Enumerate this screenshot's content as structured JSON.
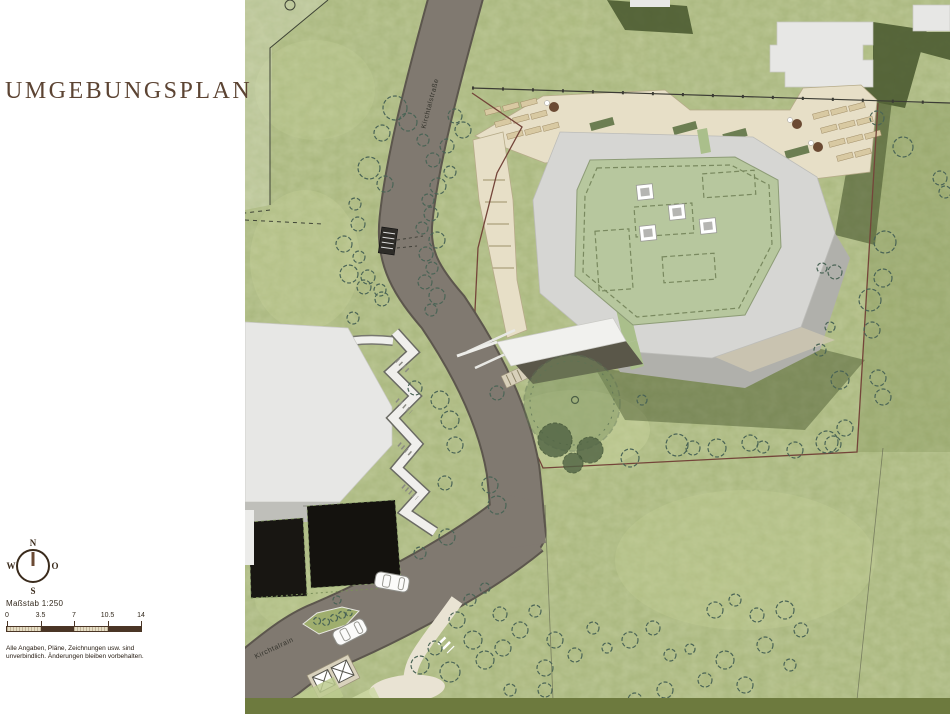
{
  "panel": {
    "title": "UMGEBUNGSPLAN",
    "scale_label": "Maßstab 1:250",
    "scale_ticks": [
      "0",
      "3.5",
      "7",
      "10.5",
      "14"
    ],
    "disclaimer_line1": "Alle Angaben, Pläne, Zeichnungen usw. sind",
    "disclaimer_line2": "unverbindlich. Änderungen bleiben vorbehalten.",
    "compass": {
      "north": "N",
      "east": "O",
      "south": "S",
      "west": "W"
    }
  },
  "map": {
    "street_labels": [
      {
        "text": "Kirchtalstraße",
        "x": 187,
        "y": 104,
        "rotate": -75
      },
      {
        "text": "Kirchtalrain",
        "x": 30,
        "y": 650,
        "rotate": -25
      }
    ],
    "palette": {
      "grass": "#a9b77c",
      "grassdark": "#46552c",
      "road": "#807970",
      "roadedge": "#5c564d",
      "beige": "#e7dfc7",
      "deck": "#d8c9a2",
      "rooflight": "#d6d6d3",
      "roofgreen": "#b7c79e",
      "boundary": "#74453a",
      "tree": "#4a6456",
      "title": "#5c4433",
      "band": "#6d7a3e"
    },
    "trees": [
      [
        150,
        108,
        12
      ],
      [
        163,
        122,
        9
      ],
      [
        137,
        133,
        8
      ],
      [
        178,
        140,
        6
      ],
      [
        124,
        168,
        11
      ],
      [
        140,
        184,
        8
      ],
      [
        110,
        204,
        6
      ],
      [
        113,
        224,
        7
      ],
      [
        99,
        244,
        8
      ],
      [
        114,
        257,
        6
      ],
      [
        104,
        274,
        9
      ],
      [
        119,
        287,
        7
      ],
      [
        137,
        299,
        7
      ],
      [
        108,
        318,
        6
      ],
      [
        123,
        277,
        7
      ],
      [
        135,
        290,
        6
      ],
      [
        210,
        116,
        7
      ],
      [
        218,
        130,
        8
      ],
      [
        202,
        146,
        7
      ],
      [
        188,
        160,
        7
      ],
      [
        205,
        172,
        6
      ],
      [
        193,
        186,
        8
      ],
      [
        183,
        200,
        6
      ],
      [
        186,
        214,
        7
      ],
      [
        177,
        228,
        6
      ],
      [
        192,
        240,
        8
      ],
      [
        181,
        254,
        7
      ],
      [
        187,
        268,
        6
      ],
      [
        180,
        282,
        7
      ],
      [
        192,
        296,
        8
      ],
      [
        186,
        310,
        6
      ],
      [
        632,
        118,
        7
      ],
      [
        658,
        147,
        10
      ],
      [
        640,
        242,
        11
      ],
      [
        638,
        278,
        9
      ],
      [
        625,
        300,
        11
      ],
      [
        627,
        330,
        8
      ],
      [
        590,
        272,
        7
      ],
      [
        577,
        268,
        5
      ],
      [
        585,
        327,
        5
      ],
      [
        575,
        350,
        6
      ],
      [
        595,
        380,
        9
      ],
      [
        633,
        378,
        8
      ],
      [
        638,
        397,
        8
      ],
      [
        600,
        428,
        8
      ],
      [
        588,
        444,
        8
      ],
      [
        695,
        178,
        7
      ],
      [
        700,
        192,
        6
      ],
      [
        385,
        458,
        9
      ],
      [
        432,
        445,
        11
      ],
      [
        448,
        448,
        7
      ],
      [
        472,
        448,
        9
      ],
      [
        505,
        443,
        8
      ],
      [
        518,
        447,
        6
      ],
      [
        550,
        450,
        8
      ],
      [
        582,
        442,
        11
      ],
      [
        170,
        388,
        7
      ],
      [
        195,
        400,
        9
      ],
      [
        205,
        420,
        9
      ],
      [
        210,
        445,
        8
      ],
      [
        245,
        485,
        8
      ],
      [
        252,
        505,
        9
      ],
      [
        202,
        537,
        8
      ],
      [
        175,
        553,
        6
      ],
      [
        200,
        483,
        7
      ],
      [
        252,
        393,
        7
      ],
      [
        397,
        400,
        5
      ],
      [
        212,
        620,
        8
      ],
      [
        228,
        640,
        9
      ],
      [
        190,
        648,
        7
      ],
      [
        175,
        665,
        9
      ],
      [
        205,
        672,
        10
      ],
      [
        240,
        660,
        9
      ],
      [
        258,
        648,
        8
      ],
      [
        275,
        630,
        8
      ],
      [
        255,
        614,
        7
      ],
      [
        290,
        611,
        6
      ],
      [
        310,
        640,
        8
      ],
      [
        330,
        655,
        7
      ],
      [
        300,
        668,
        8
      ],
      [
        348,
        628,
        6
      ],
      [
        362,
        648,
        5
      ],
      [
        385,
        640,
        8
      ],
      [
        408,
        628,
        7
      ],
      [
        300,
        690,
        7
      ],
      [
        265,
        690,
        6
      ],
      [
        425,
        655,
        6
      ],
      [
        445,
        649,
        5
      ],
      [
        470,
        610,
        8
      ],
      [
        490,
        600,
        6
      ],
      [
        512,
        615,
        7
      ],
      [
        540,
        610,
        9
      ],
      [
        556,
        630,
        7
      ],
      [
        520,
        645,
        8
      ],
      [
        480,
        660,
        9
      ],
      [
        460,
        680,
        7
      ],
      [
        500,
        685,
        8
      ],
      [
        545,
        665,
        6
      ],
      [
        420,
        690,
        8
      ],
      [
        390,
        700,
        7
      ],
      [
        225,
        600,
        6
      ],
      [
        240,
        588,
        5
      ]
    ],
    "dark_trees": [
      [
        310,
        440,
        17
      ],
      [
        345,
        450,
        13
      ],
      [
        328,
        463,
        10
      ]
    ],
    "deck_planks": [
      [
        240,
        108
      ],
      [
        258,
        104
      ],
      [
        276,
        100
      ],
      [
        250,
        120
      ],
      [
        268,
        116
      ],
      [
        286,
        112
      ],
      [
        262,
        132
      ],
      [
        280,
        128
      ],
      [
        298,
        124
      ],
      [
        568,
        112
      ],
      [
        586,
        108
      ],
      [
        604,
        104
      ],
      [
        576,
        126
      ],
      [
        594,
        122
      ],
      [
        612,
        118
      ],
      [
        584,
        140
      ],
      [
        602,
        136
      ],
      [
        620,
        132
      ],
      [
        592,
        154
      ],
      [
        610,
        150
      ]
    ],
    "planters": [
      [
        345,
        120
      ],
      [
        428,
        124
      ],
      [
        478,
        131
      ],
      [
        540,
        148
      ]
    ],
    "tables": [
      [
        309,
        107
      ],
      [
        552,
        124
      ],
      [
        573,
        147
      ]
    ],
    "cars": [
      [
        147,
        582,
        10
      ],
      [
        105,
        632,
        -27
      ]
    ],
    "skylights": [
      [
        400,
        192
      ],
      [
        432,
        212
      ],
      [
        403,
        233
      ],
      [
        463,
        226
      ]
    ]
  }
}
